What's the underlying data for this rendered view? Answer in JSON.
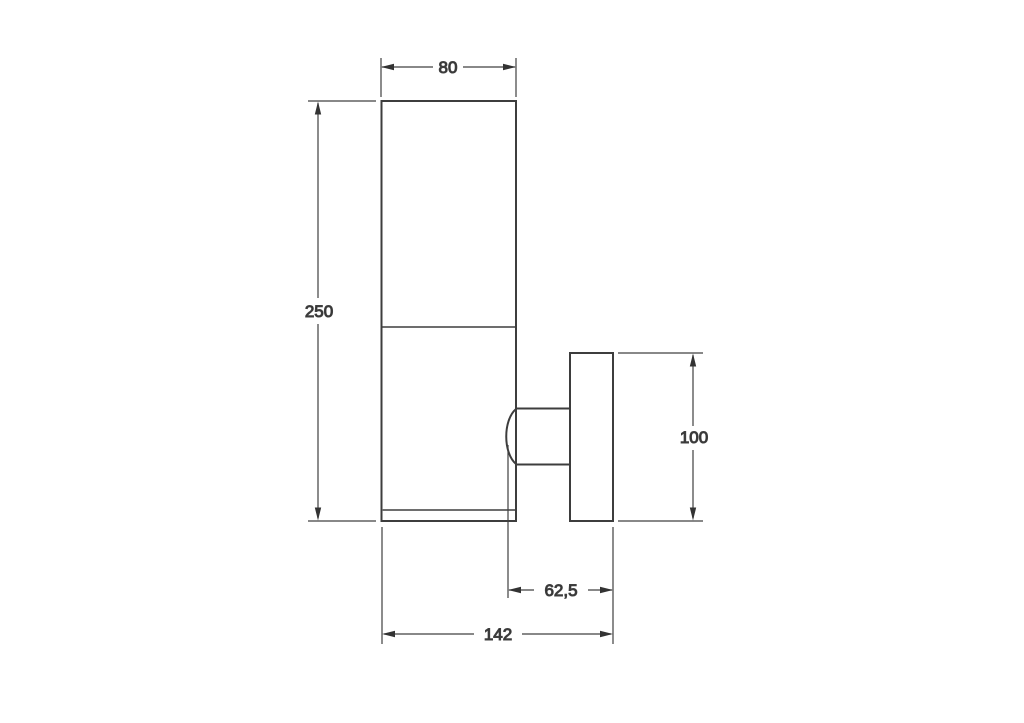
{
  "drawing": {
    "background_color": "#ffffff",
    "object_line_color": "#3d3d3d",
    "dimension_line_color": "#404040",
    "dimensions": {
      "tube_width": "80",
      "tube_height": "250",
      "plate_height": "100",
      "arm_depth": "62,5",
      "total_depth": "142"
    }
  }
}
